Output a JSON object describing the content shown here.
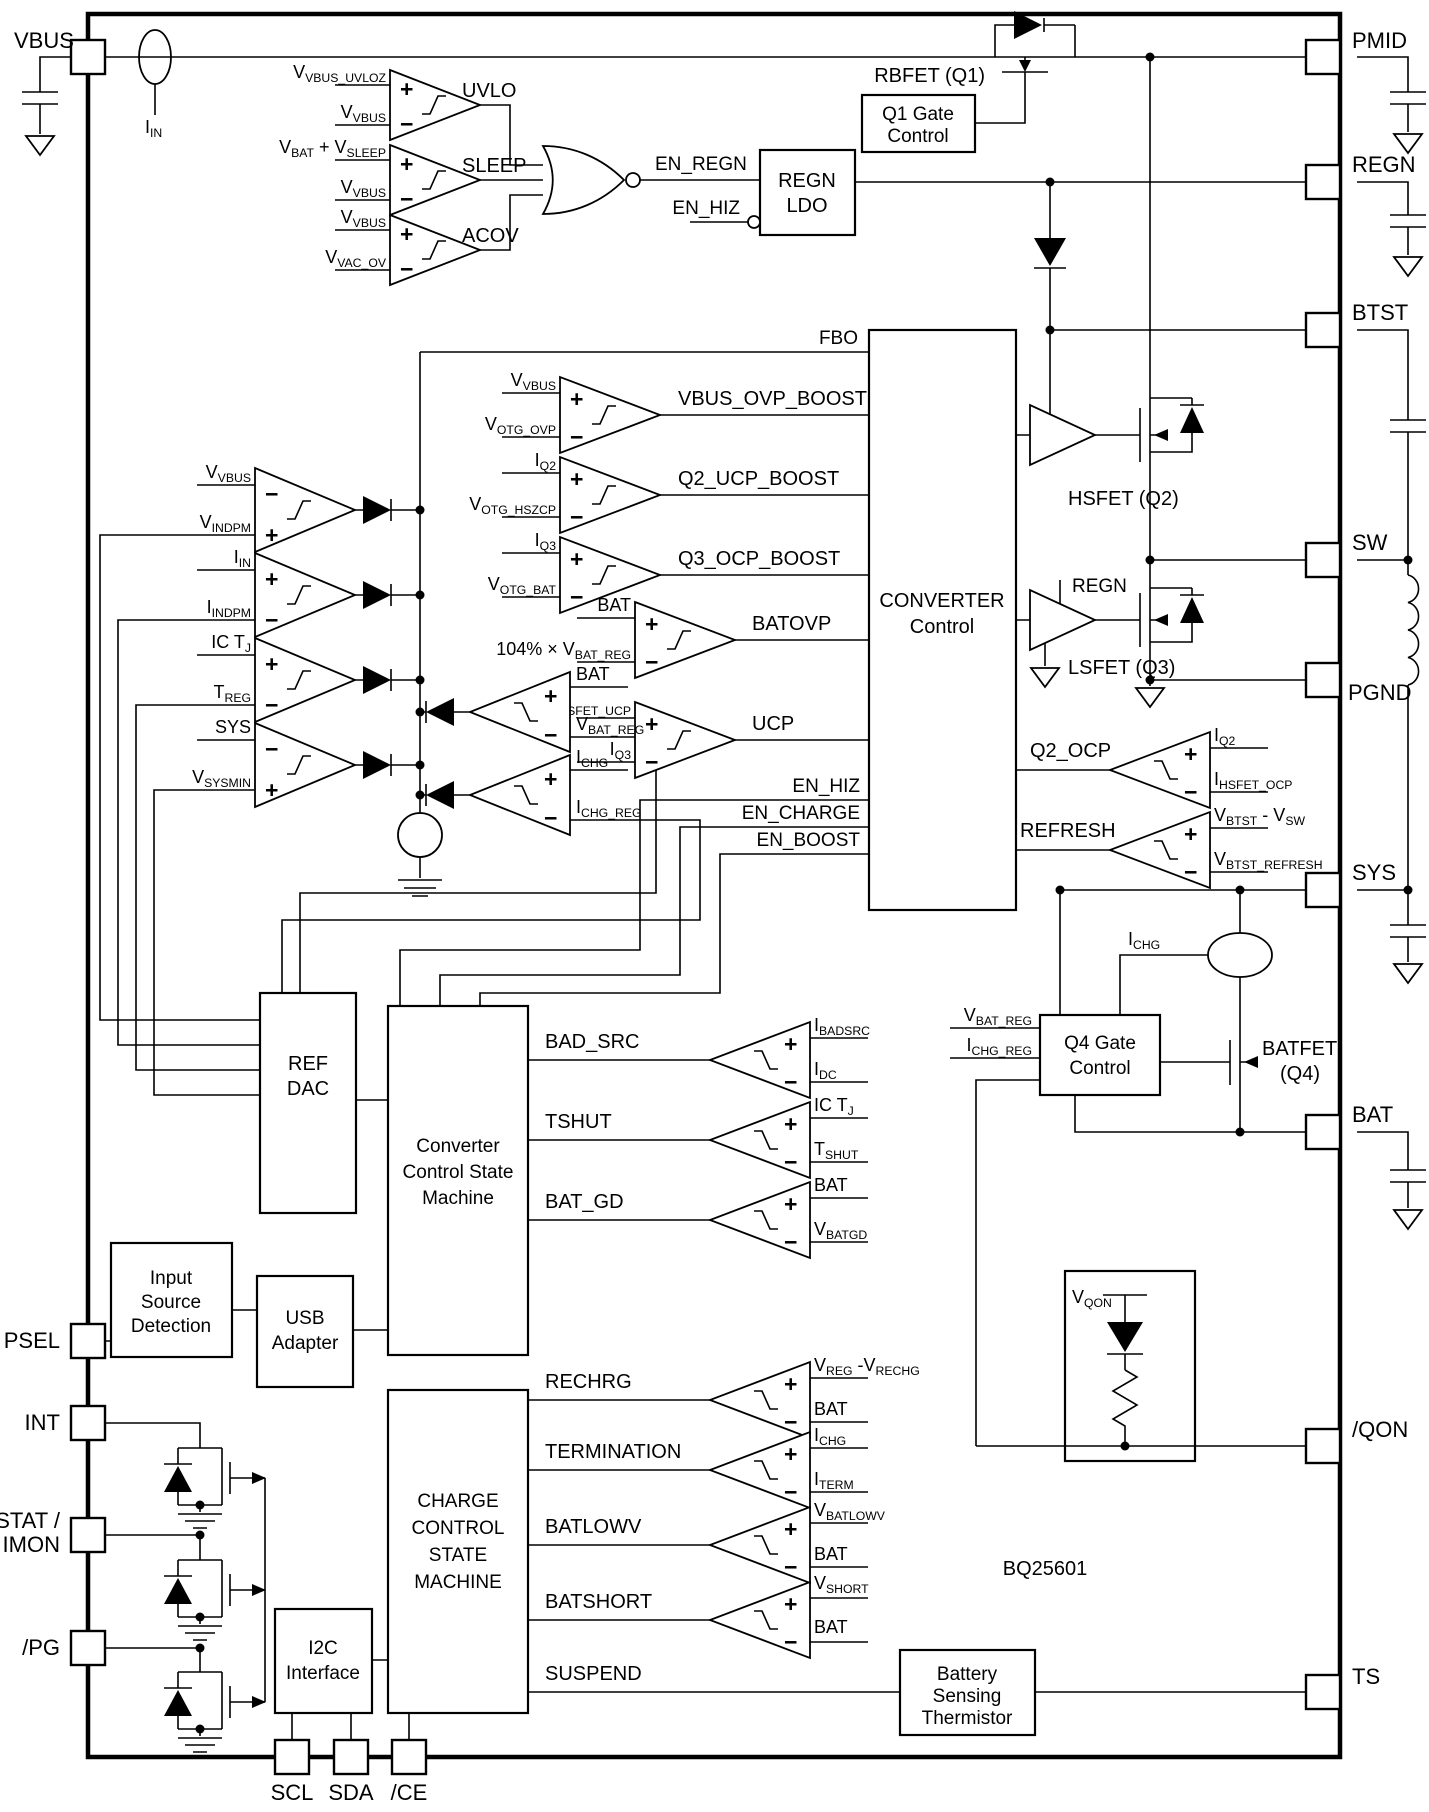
{
  "chip": {
    "name": "BQ25601"
  },
  "pins": {
    "left": {
      "vbus": "VBUS",
      "psel": "PSEL",
      "int": "INT",
      "stat1": "STAT /",
      "stat2": "IMON",
      "pg": "/PG"
    },
    "right": [
      "PMID",
      "REGN",
      "BTST",
      "SW",
      "PGND",
      "SYS",
      "BAT",
      "/QON",
      "TS"
    ],
    "bottom": [
      "SCL",
      "SDA",
      "/CE"
    ]
  },
  "blocks": {
    "q1_gate": [
      "Q1 Gate",
      "Control"
    ],
    "regn_ldo": [
      "REGN",
      "LDO"
    ],
    "converter": [
      "CONVERTER",
      "Control"
    ],
    "ref_dac": [
      "REF",
      "DAC"
    ],
    "conv_sm": [
      "Converter",
      "Control State",
      "Machine"
    ],
    "input_src": [
      "Input",
      "Source",
      "Detection"
    ],
    "usb": [
      "USB",
      "Adapter"
    ],
    "charge_sm": [
      "CHARGE",
      "CONTROL",
      "STATE",
      "MACHINE"
    ],
    "i2c": [
      "I2C",
      "Interface"
    ],
    "q4_gate": [
      "Q4 Gate",
      "Control"
    ],
    "thermistor": [
      "Battery",
      "Sensing",
      "Thermistor"
    ]
  },
  "fets": {
    "rbfet": "RBFET (Q1)",
    "hsfet": "HSFET (Q2)",
    "lsfet": "LSFET (Q3)",
    "batfet1": "BATFET",
    "batfet2": "(Q4)"
  },
  "signals": {
    "fbo": "FBO",
    "en_regn": "EN_REGN",
    "en_hiz": "EN_HIZ",
    "en_charge": "EN_CHARGE",
    "en_boost": "EN_BOOST",
    "regn_drv": "REGN",
    "suspend": "SUSPEND",
    "iin": "I~IN~",
    "ichg": "I~CHG~",
    "vbat_reg": "V~BAT_REG~",
    "ichg_reg": "I~CHG_REG~",
    "vqon": "V~QON~"
  },
  "glyphs": {
    "plus": "+",
    "minus": "−"
  },
  "comparators": [
    {
      "name": "UVLO",
      "top": "V~VBUS_UVLOZ~",
      "bot": "V~VBUS~",
      "ts": "+",
      "bs": "−"
    },
    {
      "name": "SLEEP",
      "top": "V~BAT~ + V~SLEEP~",
      "bot": "V~VBUS~",
      "ts": "+",
      "bs": "−"
    },
    {
      "name": "ACOV",
      "top": "V~VBUS~",
      "bot": "V~VAC_OV~",
      "ts": "+",
      "bs": "−"
    },
    {
      "name": "VBUS_OVP_BOOST",
      "top": "V~VBUS~",
      "bot": "V~OTG_OVP~",
      "ts": "+",
      "bs": "−"
    },
    {
      "name": "Q2_UCP_BOOST",
      "top": "I~Q2~",
      "bot": "V~OTG_HSZCP~",
      "ts": "+",
      "bs": "−"
    },
    {
      "name": "Q3_OCP_BOOST",
      "top": "I~Q3~",
      "bot": "V~OTG_BAT~",
      "ts": "+",
      "bs": "−"
    },
    {
      "name": "BATOVP",
      "top": "BAT",
      "bot": "104% × V~BAT_REG~",
      "ts": "+",
      "bs": "−"
    },
    {
      "name": "UCP",
      "top": "I~LSFET_UCP~",
      "bot": "I~Q3~",
      "ts": "+",
      "bs": "−"
    },
    {
      "name": "",
      "top": "V~VBUS~",
      "bot": "V~INDPM~",
      "ts": "−",
      "bs": "+"
    },
    {
      "name": "",
      "top": "I~IN~",
      "bot": "I~INDPM~",
      "ts": "+",
      "bs": "−"
    },
    {
      "name": "",
      "top": "IC T~J~",
      "bot": "T~REG~",
      "ts": "+",
      "bs": "−"
    },
    {
      "name": "",
      "top": "SYS",
      "bot": "V~SYSMIN~",
      "ts": "−",
      "bs": "+"
    },
    {
      "name": "",
      "top": "BAT",
      "bot": "V~BAT_REG~",
      "ts": "+",
      "bs": "−"
    },
    {
      "name": "",
      "top": "I~CHG~",
      "bot": "I~CHG_REG~",
      "ts": "+",
      "bs": "−"
    },
    {
      "name": "Q2_OCP",
      "top": "I~Q2~",
      "bot": "I~HSFET_OCP~",
      "ts": "+",
      "bs": "−"
    },
    {
      "name": "REFRESH",
      "top": "V~BTST~ - V~SW~",
      "bot": "V~BTST_REFRESH~",
      "ts": "+",
      "bs": "−"
    },
    {
      "name": "BAD_SRC",
      "top": "I~BADSRC~",
      "bot": "I~DC~",
      "ts": "+",
      "bs": "−"
    },
    {
      "name": "TSHUT",
      "top": "IC T~J~",
      "bot": "T~SHUT~",
      "ts": "+",
      "bs": "−"
    },
    {
      "name": "BAT_GD",
      "top": "BAT",
      "bot": "V~BATGD~",
      "ts": "+",
      "bs": "−"
    },
    {
      "name": "RECHRG",
      "top": "V~REG~ -V~RECHG~",
      "bot": "BAT",
      "ts": "+",
      "bs": "−"
    },
    {
      "name": "TERMINATION",
      "top": "I~CHG~",
      "bot": "I~TERM~",
      "ts": "+",
      "bs": "−"
    },
    {
      "name": "BATLOWV",
      "top": "V~BATLOWV~",
      "bot": "BAT",
      "ts": "+",
      "bs": "−"
    },
    {
      "name": "BATSHORT",
      "top": "V~SHORT~",
      "bot": "BAT",
      "ts": "+",
      "bs": "−"
    }
  ]
}
